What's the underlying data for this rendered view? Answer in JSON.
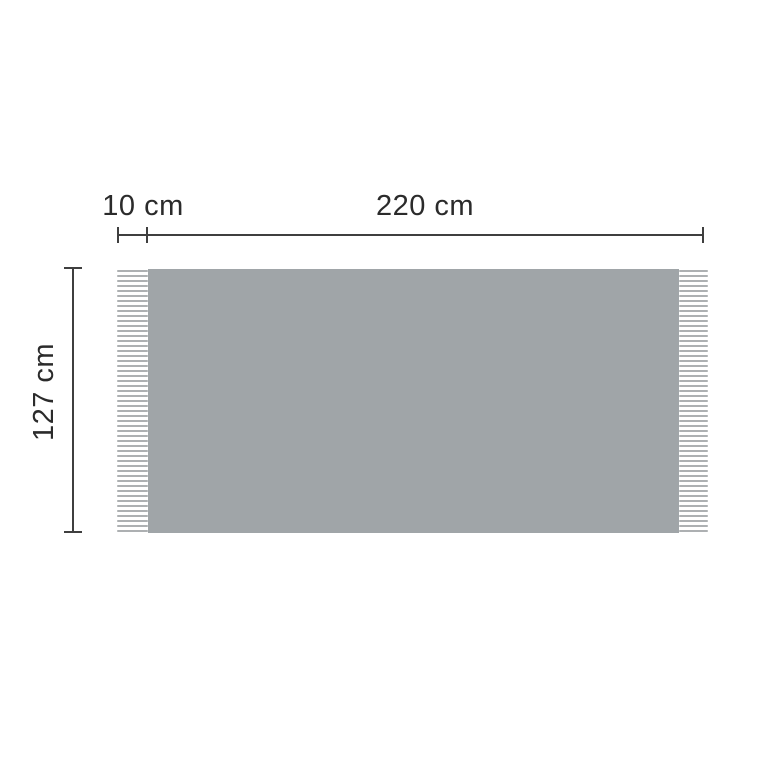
{
  "diagram": {
    "type": "product-dimension-diagram",
    "subject": "fringed blanket top view",
    "labels": {
      "fringe_width": "10 cm",
      "body_width": "220 cm",
      "height": "127 cm"
    },
    "dimensions": {
      "fringe_width_cm": 10,
      "body_width_cm": 220,
      "height_cm": 127
    },
    "fringe": {
      "strands_per_side": 53,
      "sides": [
        "left",
        "right"
      ]
    },
    "colors": {
      "background": "#ffffff",
      "body": "#a0a5a8",
      "fringe": "#adb0b2",
      "line": "#3f3f3f",
      "text": "#2b2b2b"
    }
  }
}
